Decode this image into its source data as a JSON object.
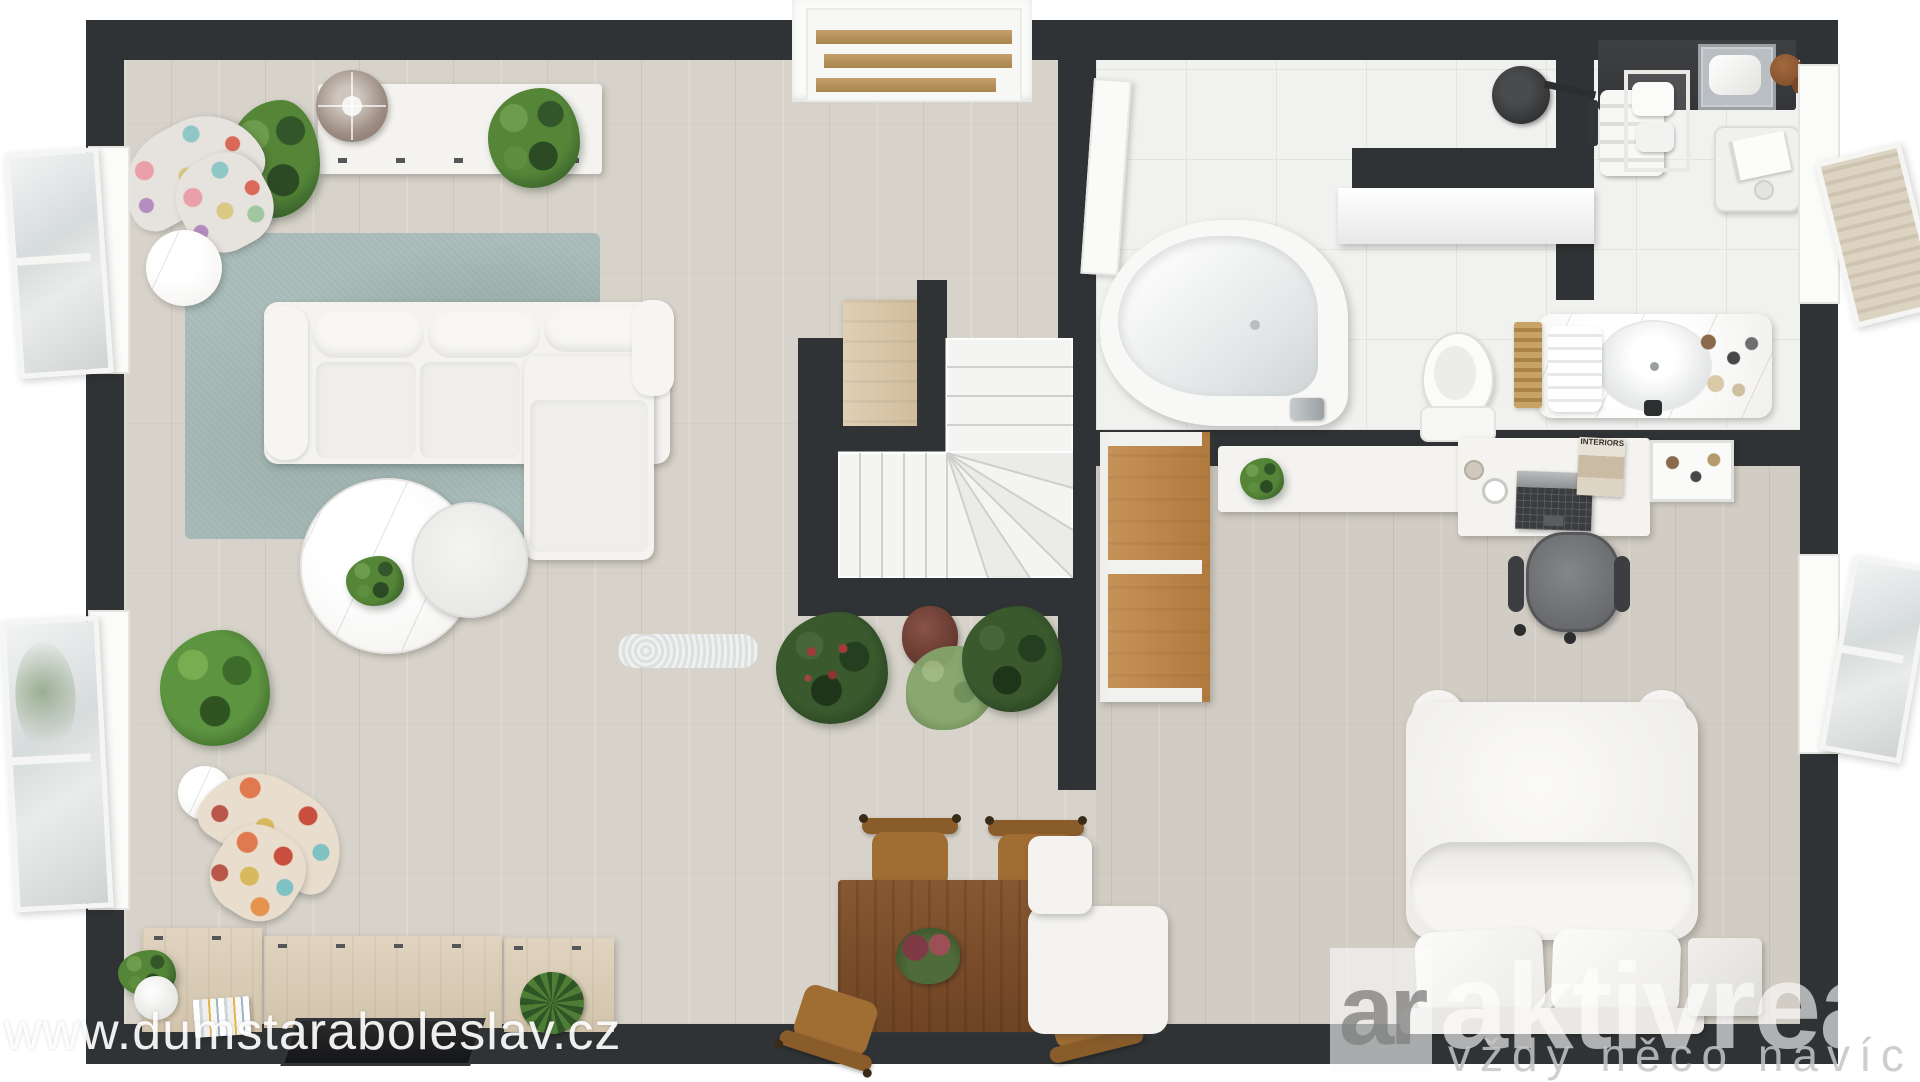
{
  "watermark": {
    "text": "www.dumstaraboleslav.cz"
  },
  "logo": {
    "monogram": "ar",
    "brand": "aktivreali",
    "tagline": "vždy něco navíc ..."
  },
  "bedroom": {
    "magazine_title": "INTERIORS"
  },
  "colors": {
    "wall": "#303335",
    "wood_floor": "#d7d3ca",
    "tile_floor": "#f1f1ef",
    "rug": "#a7bab7",
    "white_furniture": "#f4f3f0",
    "oak_wardrobe": "#bf8a50",
    "dining_table_wood": "#7d512e",
    "sideboard_wood": "#dacdb8",
    "plant_green": "#4d7d35",
    "logo_overlay": "rgba(255,255,255,0.6)"
  }
}
